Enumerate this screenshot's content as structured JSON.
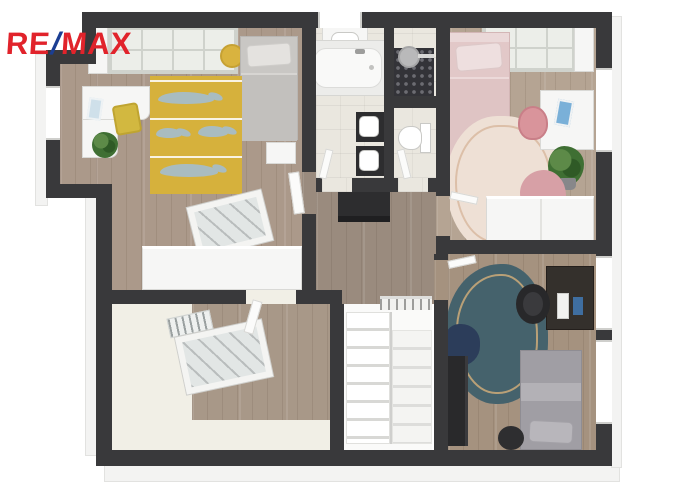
{
  "logo": {
    "re": "RE",
    "slash": "/",
    "max": "MAX",
    "color_red": "#E1232B",
    "color_blue": "#1B3E93"
  },
  "scene": {
    "description": "3D top-down floor plan rendering of an attic storey",
    "palette": {
      "wall": "#39393b",
      "wood_floor": "#a5947f",
      "bathroom_tile": "#eae7df",
      "sloped_ceiling": "#f1efe6",
      "rug_yellow": "#d6b13c",
      "rug_fox_gray": "#a9bcc0",
      "rug_pink": "#eee0d5",
      "rug_teal": "#45626c",
      "bed_pink": "#e2c8c8",
      "bed_gray": "#a09ea4",
      "beanbag_pink": "#d7a0a6",
      "beanbag_navy": "#2c3d5a",
      "furniture_white": "#f6f6f5",
      "furniture_dark": "#2d2d2f",
      "shower_tile_dark": "#333338"
    },
    "rooms": [
      {
        "name": "children-room",
        "position": "top-left",
        "floor": "wood",
        "items": [
          "white-wardrobe",
          "bookshelf",
          "yellow-stool",
          "single-bed-gray",
          "nightstand",
          "fox-pattern-yellow-rug",
          "white-desk",
          "laptop",
          "yellow-chair",
          "plant",
          "roof-window"
        ]
      },
      {
        "name": "bathroom",
        "position": "top-center",
        "floor": "tile",
        "items": [
          "washbasin-cabinet",
          "bathtub",
          "walk-in-shower",
          "rain-shower-head",
          "double-sink",
          "toilet"
        ]
      },
      {
        "name": "bedroom-pink",
        "position": "top-right",
        "floor": "wood",
        "items": [
          "bookshelf",
          "single-bed-pink",
          "white-desk",
          "laptop",
          "pink-chair",
          "plant",
          "pink-beanbag",
          "organic-pink-rug",
          "white-wardrobe"
        ]
      },
      {
        "name": "hallway",
        "position": "center",
        "floor": "wood",
        "items": [
          "black-dresser"
        ]
      },
      {
        "name": "attic-room",
        "position": "bottom-left",
        "floor": "wood-with-sloped-ceiling",
        "items": [
          "roof-window",
          "loft-ladder"
        ]
      },
      {
        "name": "staircase",
        "position": "bottom-center",
        "items": [
          "two-flight-stairs",
          "railing"
        ]
      },
      {
        "name": "bedroom-blue",
        "position": "bottom-right",
        "floor": "wood",
        "items": [
          "organic-teal-rug",
          "navy-beanbag",
          "dark-sideboard",
          "dark-desk",
          "monitor",
          "office-chair",
          "single-bed-gray",
          "dark-pouf"
        ]
      }
    ]
  }
}
